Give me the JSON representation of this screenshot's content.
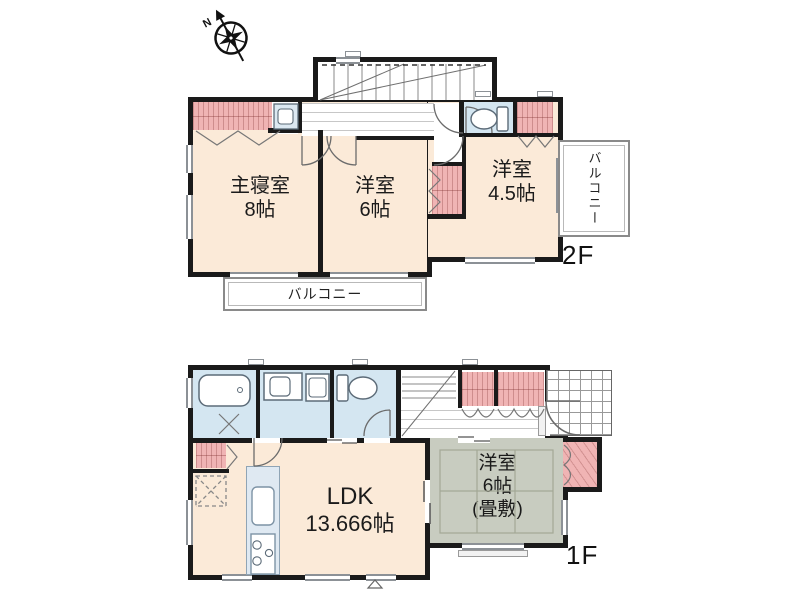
{
  "compass": {
    "label": "N"
  },
  "f2": {
    "label": "2F",
    "rooms": {
      "master": {
        "name": "主寝室",
        "size": "8帖"
      },
      "west6": {
        "name": "洋室",
        "size": "6帖"
      },
      "west45": {
        "name": "洋室",
        "size": "4.5帖"
      }
    },
    "balcony_right": "バルコニー",
    "balcony_bottom": "バルコニー"
  },
  "f1": {
    "label": "1F",
    "rooms": {
      "ldk": {
        "name": "LDK",
        "size": "13.666帖"
      },
      "tatami": {
        "name": "洋室",
        "size": "6帖",
        "note": "(畳敷)"
      }
    }
  },
  "icons": {
    "compass": "compass-rose",
    "bathtub": "bathtub",
    "toilet_2f": "toilet",
    "toilet_1f": "toilet",
    "vanity_2f": "vanity-sink",
    "vanity_1f": "vanity-sink",
    "washing_machine": "washing-machine",
    "kitchen_sink": "kitchen-sink",
    "stove": "stove",
    "stairs_2f": "staircase",
    "stairs_1f": "staircase",
    "refrigerator_space": "refrigerator-space"
  },
  "colors": {
    "wall": "#1a1a1a",
    "cream": "#fbead8",
    "pink": "#f0b4b4",
    "blue": "#d4e6f1",
    "tatami": "#c8ccc0",
    "line": "#8c9196",
    "label": "#1b1b1b"
  }
}
